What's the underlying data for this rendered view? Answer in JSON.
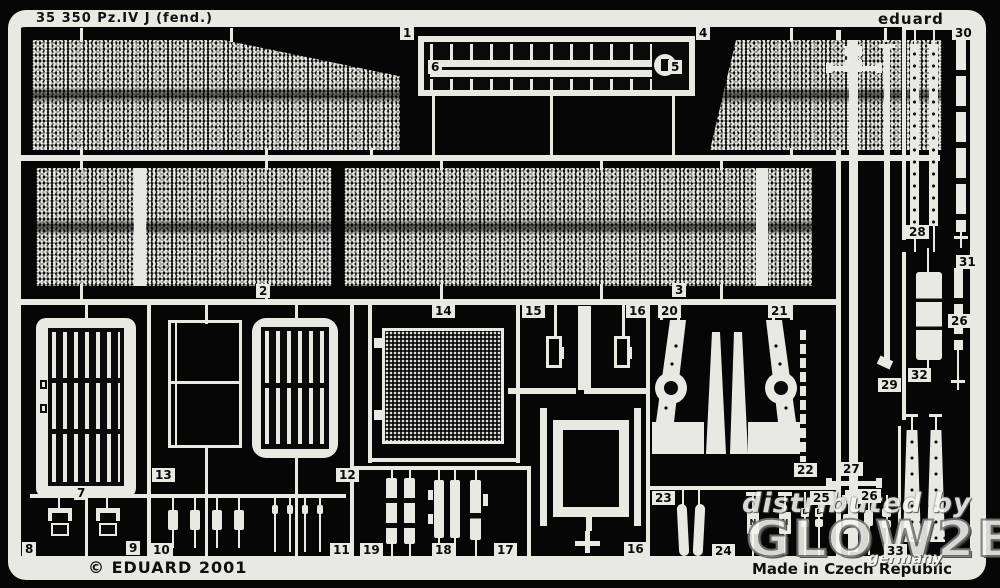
{
  "header": {
    "title": "35 350 Pz.IV J (fend.)",
    "brand": "eduard"
  },
  "footer": {
    "copyright": "© EDUARD 2001",
    "made_in": "Made in Czech Republic"
  },
  "watermark": {
    "line1": "distributed by",
    "line2": "GLOW2B",
    "line3": "germany"
  },
  "part_labels": {
    "p1": "1",
    "p2": "2",
    "p3": "3",
    "p4": "4",
    "p5": "5",
    "p6": "6",
    "p7": "7",
    "p8": "8",
    "p9": "9",
    "p10": "10",
    "p11": "11",
    "p12": "12",
    "p13": "13",
    "p14": "14",
    "p15": "15",
    "p16": "16",
    "p16b": "16",
    "p17": "17",
    "p18": "18",
    "p19": "19",
    "p20": "20",
    "p21": "21",
    "p22": "22",
    "p23": "23",
    "p24": "24",
    "p25": "25",
    "p26": "26",
    "p26b": "26",
    "p27": "27",
    "p28": "28",
    "p29": "29",
    "p30": "30",
    "p31": "31",
    "p32": "32",
    "p33": "33"
  },
  "pin_marks": {
    "n": "N",
    "b": "B"
  }
}
